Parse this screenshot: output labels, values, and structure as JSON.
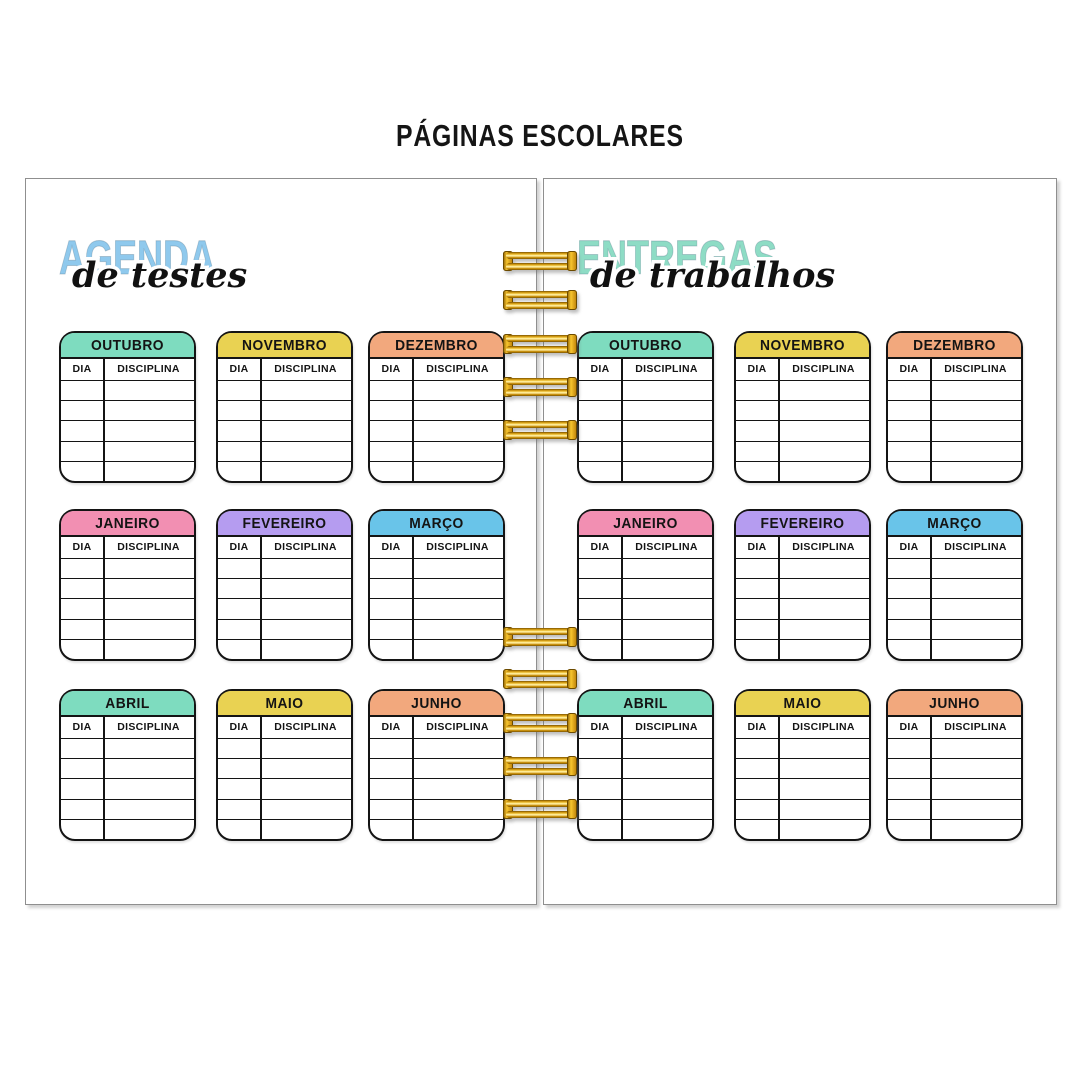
{
  "title": "PÁGINAS ESCOLARES",
  "pages": {
    "left": {
      "heading_main": "AGENDA",
      "heading_sub": "de testes"
    },
    "right": {
      "heading_main": "ENTREGAS",
      "heading_sub": "de trabalhos"
    }
  },
  "months": [
    {
      "name": "OUTUBRO",
      "color": "#7EDCBF"
    },
    {
      "name": "NOVEMBRO",
      "color": "#E9D252"
    },
    {
      "name": "DEZEMBRO",
      "color": "#F2A87D"
    },
    {
      "name": "JANEIRO",
      "color": "#F28FB2"
    },
    {
      "name": "FEVEREIRO",
      "color": "#B59CF0"
    },
    {
      "name": "MARÇO",
      "color": "#69C4E9"
    },
    {
      "name": "ABRIL",
      "color": "#7EDCBF"
    },
    {
      "name": "MAIO",
      "color": "#E9D252"
    },
    {
      "name": "JUNHO",
      "color": "#F2A87D"
    }
  ],
  "table": {
    "columns": [
      "DIA",
      "DISCIPLINA"
    ],
    "empty_rows": 5
  },
  "colors": {
    "heading_left": "#8FC9ED",
    "heading_right": "#8EDCC5",
    "spiral_gold": "#E8B422",
    "page_border": "#8F8F8F"
  }
}
